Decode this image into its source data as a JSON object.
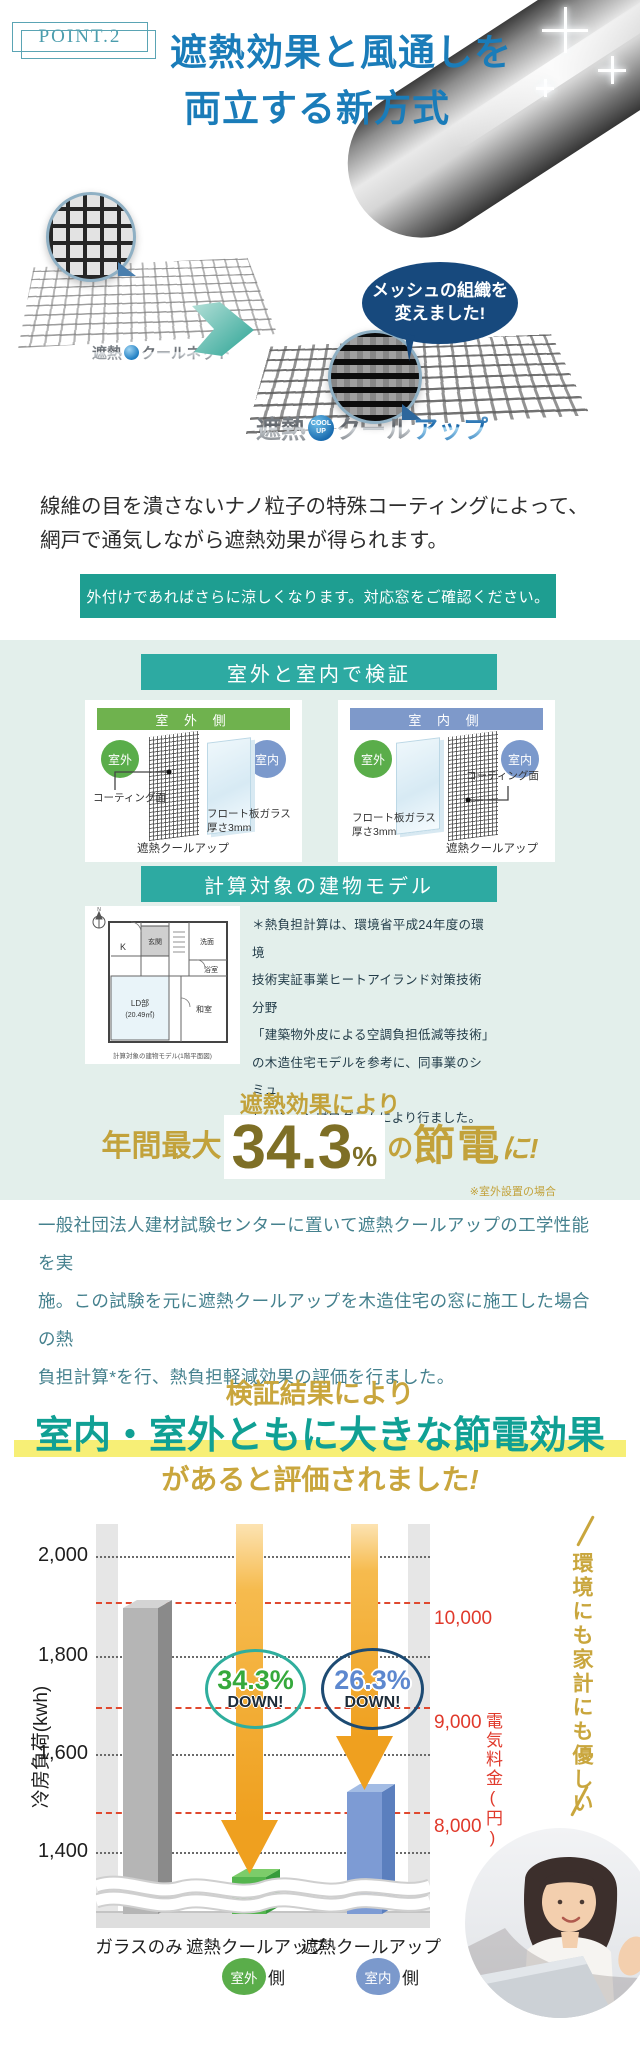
{
  "point_label": "POINT.2",
  "heading": {
    "line1": "遮熱効果と風通しを",
    "line2": "両立する新方式"
  },
  "mesh_compare": {
    "before_name": "遮熱クールネット",
    "bubble_line1": "メッシュの組織を",
    "bubble_line2": "変えました!",
    "after_name_prefix": "遮熱",
    "badge_line1": "COOL",
    "badge_line2": "UP",
    "after_name_mid": "クール",
    "after_name_suffix": "アップ"
  },
  "intro": {
    "line1": "線維の目を潰さないナノ粒子の特殊コーティングによって、",
    "line2": "網戸で通気しながら遮熱効果が得られます。"
  },
  "banner": "外付けであればさらに涼しくなります。対応窓をご確認ください。",
  "verification": {
    "header": "室外と室内で検証",
    "cards": [
      {
        "title": "室 外 側",
        "left_circle": "室外",
        "right_circle": "室内",
        "coating_label": "コーティング面",
        "glass_label1": "フロート板ガラス",
        "glass_label2": "厚さ3mm",
        "product_label": "遮熱クールアップ"
      },
      {
        "title": "室 内 側",
        "left_circle": "室外",
        "right_circle": "室内",
        "coating_label": "コーティング面",
        "glass_label1": "フロート板ガラス",
        "glass_label2": "厚さ3mm",
        "product_label": "遮熱クールアップ"
      }
    ]
  },
  "building_model": {
    "header": "計算対象の建物モデル",
    "floorplan": {
      "compass": "N",
      "room_k": "K",
      "room_genkan": "玄関",
      "room_senmen": "洗面",
      "room_yokushitsu": "浴室",
      "room_ld": "LD部",
      "room_ld_area": "(20.49㎡)",
      "room_washitsu": "和室",
      "caption": "計算対象の建物モデル(1階平面図)"
    },
    "note_lines": [
      "＊熱負担計算は、環境省平成24年度の環境",
      "技術実証事業ヒートアイランド対策技術分野",
      "「建築物外皮による空調負担低減等技術」",
      "の木造住宅モデルを参考に、同事業のシミュ",
      "レーションプログラムにより行ました。"
    ]
  },
  "savings": {
    "lead": "遮熱効果により",
    "prefix": "年間最大",
    "value": "34.3",
    "unit": "%",
    "mid": "の",
    "emph": "節電",
    "tail": "に!",
    "note": "※室外設置の場合"
  },
  "description_lines": [
    "一般社団法人建材試験センターに置いて遮熱クールアップの工学性能を実",
    "施。この試験を元に遮熱クールアップを木造住宅の窓に施工した場合の熱",
    "負担計算*を行、熱負担軽減効果の評価を行ました。"
  ],
  "conclusion": {
    "line1": "検証結果により",
    "line2": "室内・室外ともに大きな節電効果",
    "line3": "があると評価されました",
    "bang": "!"
  },
  "chart_data": {
    "type": "bar",
    "categories": [
      "ガラスのみ",
      "遮熱クールアップ(室外側)",
      "遮熱クールアップ(室内側)"
    ],
    "series": [
      {
        "name": "冷房負荷(kwh)",
        "values": [
          1900,
          1350,
          1520
        ]
      }
    ],
    "x_labels": [
      "ガラスのみ",
      "遮熱クールアップ",
      "遮熱クールアップ"
    ],
    "badges": [
      {
        "circle": "室外",
        "suffix": "側"
      },
      {
        "circle": "室内",
        "suffix": "側"
      }
    ],
    "left_axis": {
      "label": "冷房負荷(kwh)",
      "ticks": [
        "2,000",
        "1,800",
        "1,600",
        "1,400"
      ],
      "range": [
        1400,
        2000
      ]
    },
    "right_axis": {
      "label": "電気料金(円)",
      "ticks": [
        "10,000",
        "9,000",
        "8,000"
      ],
      "range": [
        8000,
        10000
      ]
    },
    "reductions": [
      {
        "percent": "34.3%",
        "caption": "DOWN!"
      },
      {
        "percent": "26.3%",
        "caption": "DOWN!"
      }
    ],
    "side_note": "環境にも家計にも優しい",
    "axis_break": true,
    "grid": true,
    "colors": {
      "bar_glass": "#b5b5b5",
      "bar_outdoor": "#54b54e",
      "bar_indoor": "#7d9bd4",
      "arrow": "#efa01f",
      "right_axis_red": "#e0392b",
      "accent_teal": "#10a094",
      "accent_gold": "#c9a63d"
    }
  },
  "colors": {
    "heading_blue": "#1a7cb9",
    "banner_teal": "#1e9e91",
    "section_bg": "#e3efeb",
    "teal_header": "#2daaa2",
    "green_header": "#6fb24e",
    "blue_header": "#7e99ca",
    "gold": "#c2a23b",
    "olive": "#7e6f26",
    "paragraph_teal": "#45818e",
    "highlight_yellow": "#f7ef76",
    "bubble_navy": "#17497d"
  }
}
